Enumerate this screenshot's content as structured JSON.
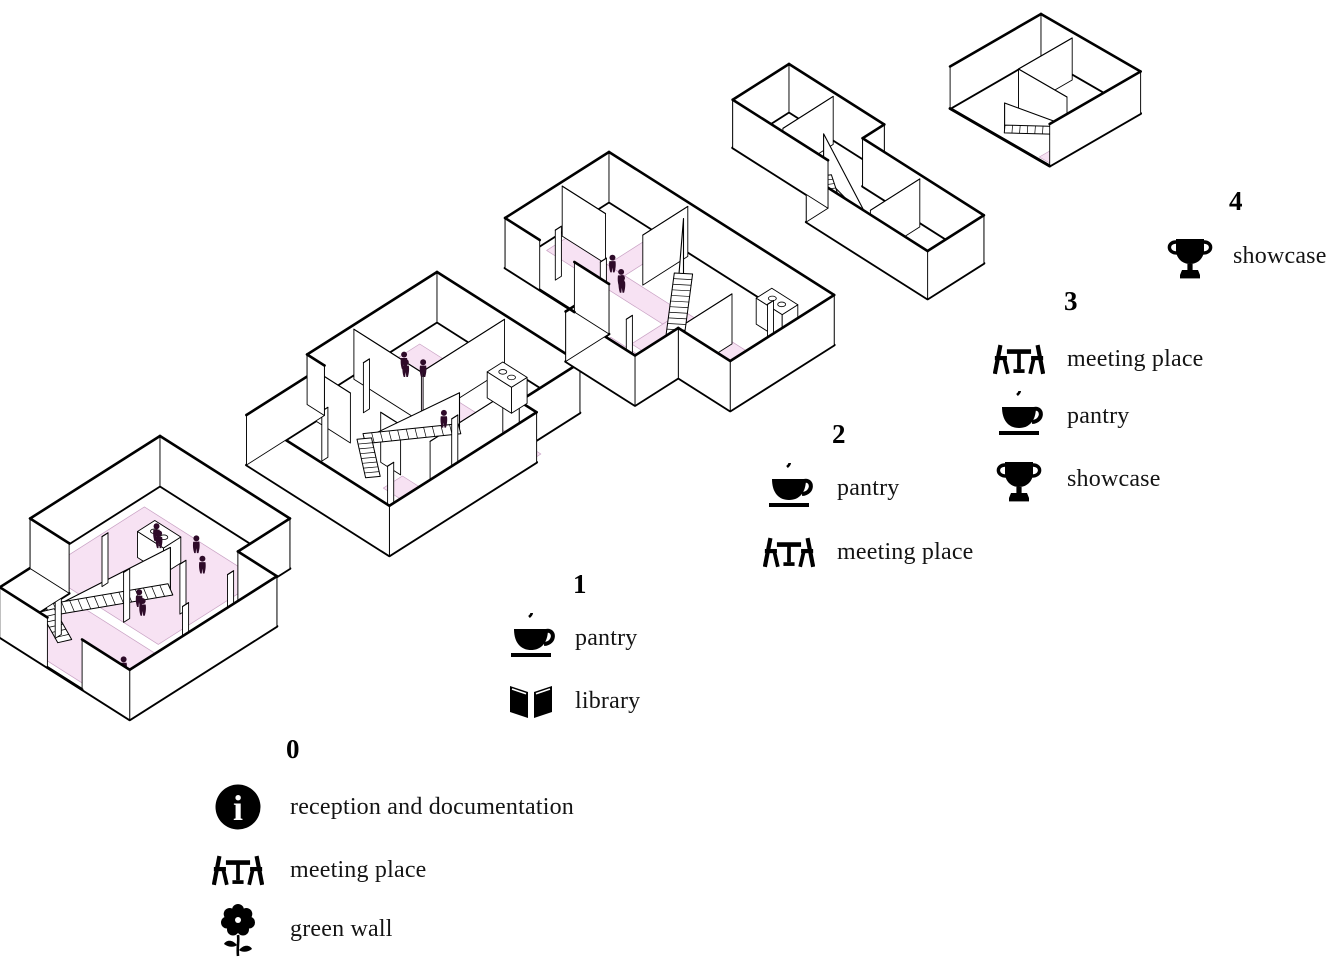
{
  "diagram": {
    "type": "exploded-axonometric-floor-plans",
    "background": "#ffffff",
    "colors": {
      "floor_highlight": "#f7e2f3",
      "outline": "#000000",
      "wall_fill": "#ffffff",
      "figure": "#2e0b29",
      "text": "#141414"
    },
    "floors": [
      {
        "number": "0",
        "legend": [
          {
            "icon": "info",
            "label": "reception and documentation"
          },
          {
            "icon": "meeting-place",
            "label": "meeting place"
          },
          {
            "icon": "green-wall",
            "label": "green wall"
          }
        ]
      },
      {
        "number": "1",
        "legend": [
          {
            "icon": "pantry",
            "label": "pantry"
          },
          {
            "icon": "library",
            "label": "library"
          }
        ]
      },
      {
        "number": "2",
        "legend": [
          {
            "icon": "pantry",
            "label": "pantry"
          },
          {
            "icon": "meeting-place",
            "label": "meeting place"
          }
        ]
      },
      {
        "number": "3",
        "legend": [
          {
            "icon": "meeting-place",
            "label": "meeting place"
          },
          {
            "icon": "pantry",
            "label": "pantry"
          },
          {
            "icon": "showcase",
            "label": "showcase"
          }
        ]
      },
      {
        "number": "4",
        "legend": [
          {
            "icon": "showcase",
            "label": "showcase"
          }
        ]
      }
    ]
  }
}
